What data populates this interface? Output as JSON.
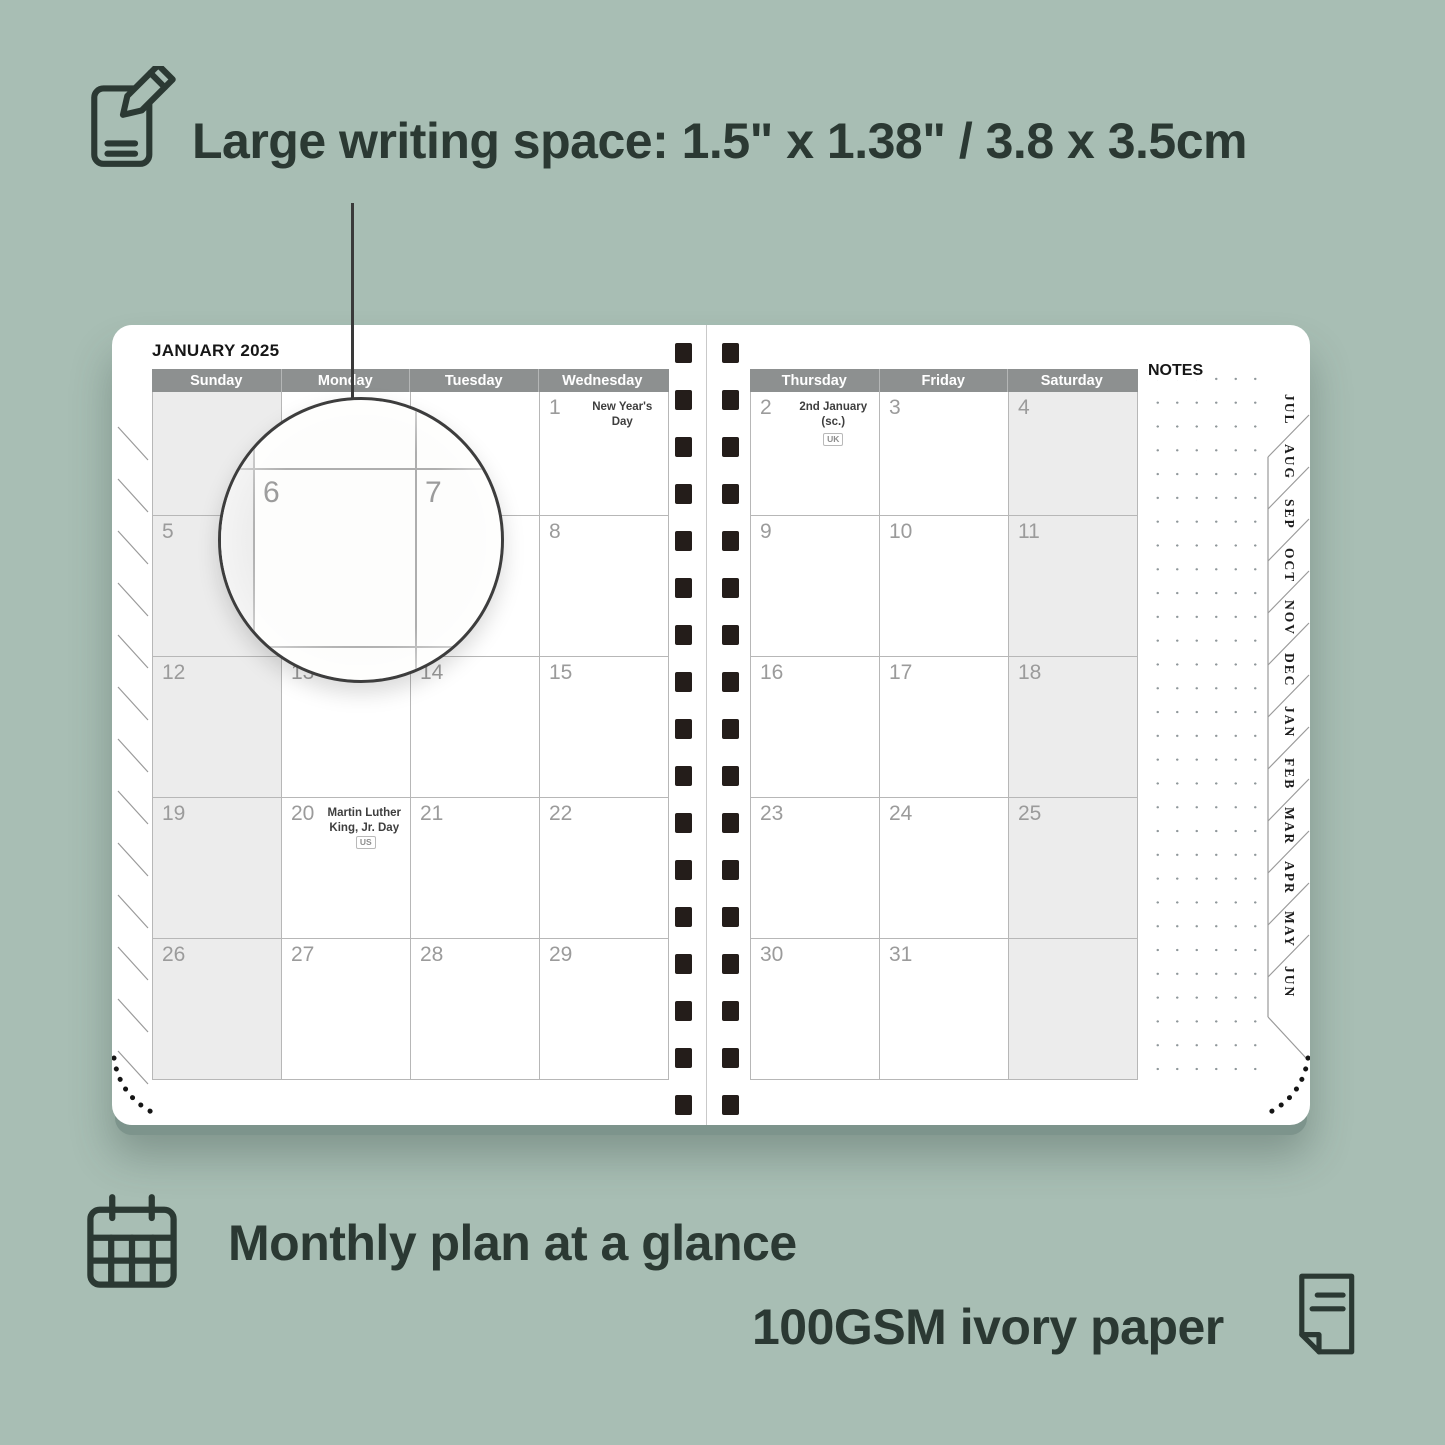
{
  "colors": {
    "background": "#a8beb4",
    "page": "#ffffff",
    "header_bar": "#8d9090",
    "shaded_cell": "#ececec",
    "day_number": "#9b9b9b",
    "grid_line": "#b7b7b7",
    "feature_text": "#2b3933",
    "binding_hole": "#241d1a"
  },
  "features": {
    "writing_space": "Large writing space: 1.5\" x 1.38\" / 3.8 x 3.5cm",
    "monthly_plan": "Monthly plan at a glance",
    "paper": "100GSM ivory paper"
  },
  "planner": {
    "title": "JANUARY 2025",
    "notes_label": "NOTES",
    "left_headers": [
      "Sunday",
      "Monday",
      "Tuesday",
      "Wednesday"
    ],
    "right_headers": [
      "Thursday",
      "Friday",
      "Saturday"
    ],
    "left_weeks": [
      [
        {
          "day": "",
          "shaded": true
        },
        {
          "day": ""
        },
        {
          "day": ""
        },
        {
          "day": "1",
          "holiday": "New Year's Day"
        }
      ],
      [
        {
          "day": "5",
          "shaded": true
        },
        {
          "day": "6"
        },
        {
          "day": "7"
        },
        {
          "day": "8"
        }
      ],
      [
        {
          "day": "12",
          "shaded": true
        },
        {
          "day": "13"
        },
        {
          "day": "14"
        },
        {
          "day": "15"
        }
      ],
      [
        {
          "day": "19",
          "shaded": true
        },
        {
          "day": "20",
          "holiday": "Martin Luther King, Jr. Day",
          "badge": "US"
        },
        {
          "day": "21"
        },
        {
          "day": "22"
        }
      ],
      [
        {
          "day": "26",
          "shaded": true
        },
        {
          "day": "27"
        },
        {
          "day": "28"
        },
        {
          "day": "29"
        }
      ]
    ],
    "right_weeks": [
      [
        {
          "day": "2",
          "holiday": "2nd January (sc.)",
          "badge": "UK",
          "badge_below": true
        },
        {
          "day": "3"
        },
        {
          "day": "4",
          "shaded": true
        }
      ],
      [
        {
          "day": "9"
        },
        {
          "day": "10"
        },
        {
          "day": "11",
          "shaded": true
        }
      ],
      [
        {
          "day": "16"
        },
        {
          "day": "17"
        },
        {
          "day": "18",
          "shaded": true
        }
      ],
      [
        {
          "day": "23"
        },
        {
          "day": "24"
        },
        {
          "day": "25",
          "shaded": true
        }
      ],
      [
        {
          "day": "30"
        },
        {
          "day": "31"
        },
        {
          "day": "",
          "shaded": true
        }
      ]
    ],
    "month_tabs": [
      "JUL",
      "AUG",
      "SEP",
      "OCT",
      "NOV",
      "DEC",
      "JAN",
      "FEB",
      "MAR",
      "APR",
      "MAY",
      "JUN"
    ]
  },
  "magnifier": {
    "left_day": "6",
    "right_day": "7"
  }
}
